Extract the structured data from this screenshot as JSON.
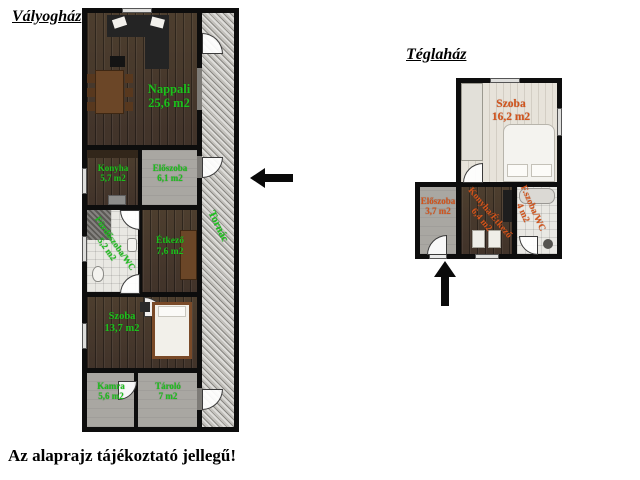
{
  "page": {
    "footer_note": "Az alaprajz tájékoztató jellegű!",
    "background": "#ffffff"
  },
  "colors": {
    "valyoghaz_label": "#1dc01d",
    "teglahaz_label": "#d2541c",
    "walls": "#0d0d0d"
  },
  "arrows": {
    "valyoghaz_entrance": "left-arrow",
    "teglahaz_entrance": "up-arrow"
  },
  "valyoghaz": {
    "title": "Vályogház",
    "rooms": [
      {
        "name": "Nappali",
        "area": "25,6 m2"
      },
      {
        "name": "Konyha",
        "area": "5,7 m2"
      },
      {
        "name": "Előszoba",
        "area": "6,1 m2"
      },
      {
        "name": "Fürdőszoba/WC",
        "area": "5,2 m2"
      },
      {
        "name": "Étkező",
        "area": "7,6 m2"
      },
      {
        "name": "Szoba",
        "area": "13,7 m2"
      },
      {
        "name": "Kamra",
        "area": "5,6 m2"
      },
      {
        "name": "Tároló",
        "area": "7 m2"
      },
      {
        "name": "Tornác",
        "area": ""
      }
    ]
  },
  "teglahaz": {
    "title": "Téglaház",
    "rooms": [
      {
        "name": "Szoba",
        "area": "16,2 m2"
      },
      {
        "name": "Előszoba",
        "area": "3,7 m2"
      },
      {
        "name": "Konyha/Étkező",
        "area": "6,4 m2"
      },
      {
        "name": "F.szoba/WC",
        "area": "4 m2"
      }
    ]
  }
}
